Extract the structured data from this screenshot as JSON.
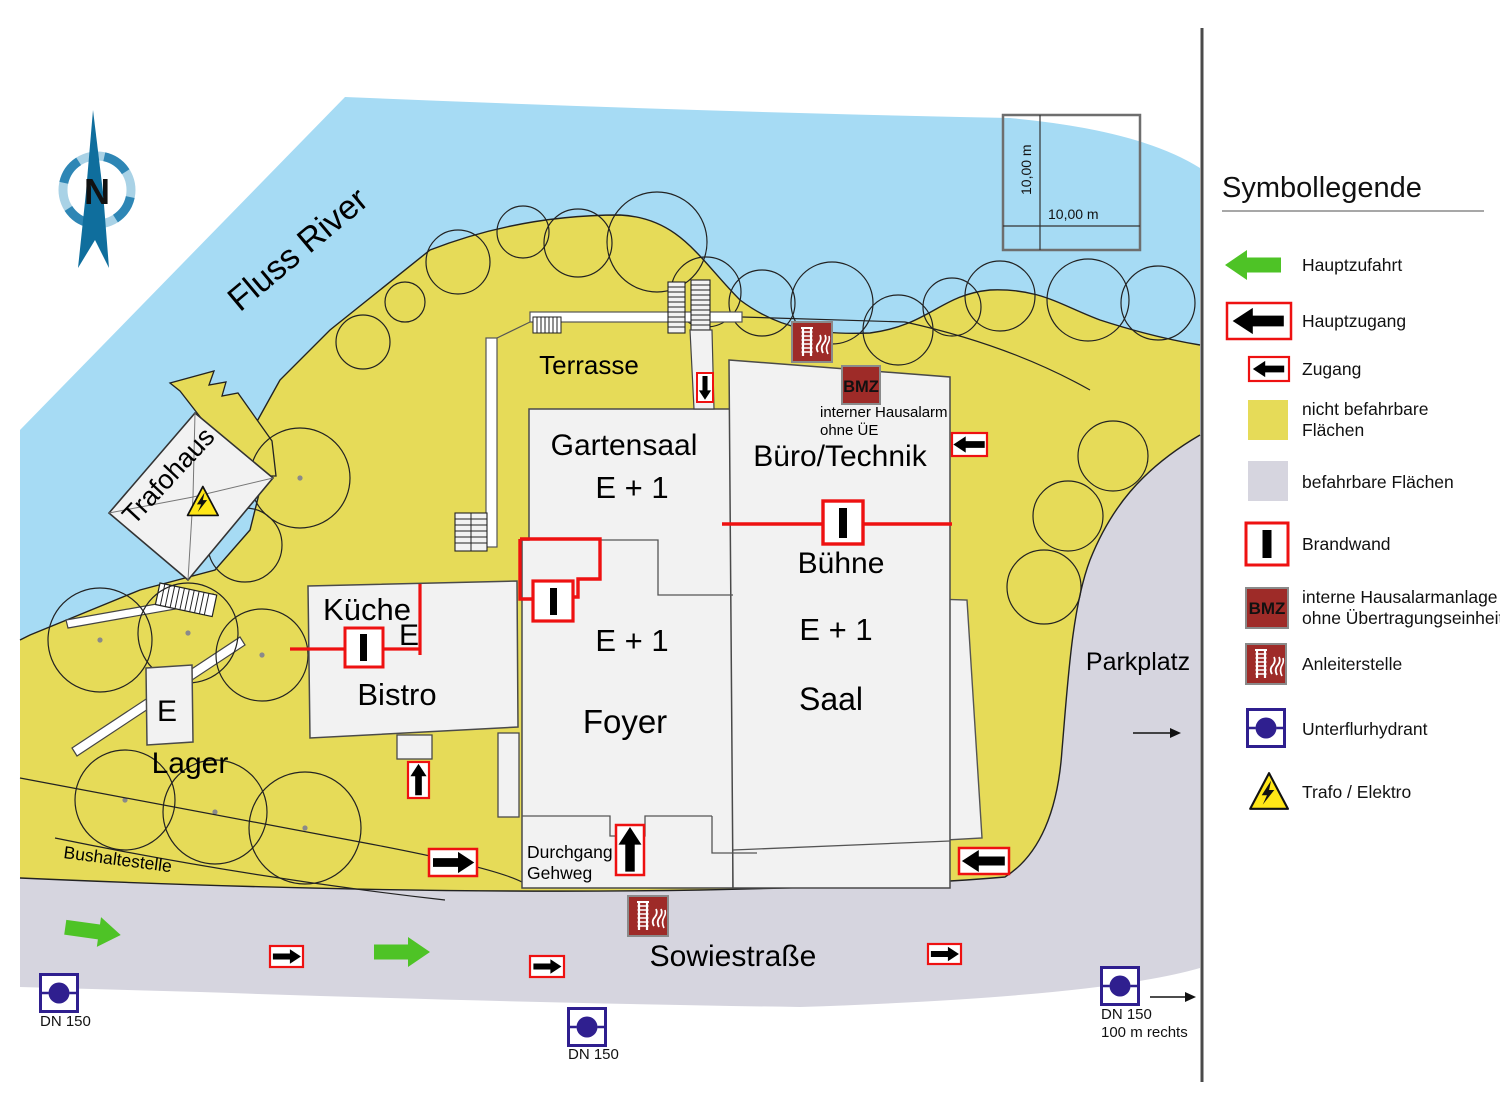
{
  "colors": {
    "water": "#A6DBF4",
    "restricted_area": "#E6DB58",
    "drivable_area": "#D6D5DF",
    "building": "#F2F2F2",
    "brandwand_red": "#EE1111",
    "alarm_red": "#9E2B28",
    "hydrant_blue": "#2F1F8F",
    "access_green": "#4EC326",
    "trafo_yellow": "#FFE617",
    "compass_blue": "#0F6E9D"
  },
  "map": {
    "river_label": "Fluss River",
    "compass_letter": "N",
    "scale_vertical_label": "10,00 m",
    "scale_horizontal_label": "10,00 m",
    "terrasse_label": "Terrasse",
    "trafohaus_label": "Trafohaus",
    "bushaltestelle_label": "Bushaltestelle",
    "sowiestrasse_label": "Sowiestraße",
    "parkplatz_label": "Parkplatz",
    "bmz_label": "BMZ",
    "hausalarm_note_line1": "interner Hausalarm",
    "hausalarm_note_line2": "ohne ÜE",
    "buildings": {
      "gartensaal_name": "Gartensaal",
      "gartensaal_level": "E + 1",
      "kueche_name": "Küche",
      "kueche_level": "E",
      "bistro_name": "Bistro",
      "lager_level": "E",
      "lager_name": "Lager",
      "foyer_level": "E + 1",
      "foyer_name": "Foyer",
      "durchgang_line1": "Durchgang",
      "durchgang_line2": "Gehweg",
      "buero_name": "Büro/Technik",
      "buehne_name": "Bühne",
      "saal_level": "E + 1",
      "saal_name": "Saal"
    },
    "hydrants": {
      "west_label": "DN 150",
      "center_label": "DN 150",
      "east_label_line1": "DN 150",
      "east_label_line2": "100 m rechts"
    }
  },
  "legend": {
    "title": "Symbollegende",
    "bmz_icon_text": "BMZ",
    "items": [
      {
        "label": "Hauptzufahrt"
      },
      {
        "label": "Hauptzugang"
      },
      {
        "label": "Zugang"
      },
      {
        "label": "nicht befahrbare",
        "label2": "Flächen"
      },
      {
        "label": "befahrbare Flächen"
      },
      {
        "label": "Brandwand"
      },
      {
        "label": "interne Hausalarmanlage",
        "label2": "ohne Übertragungseinheit"
      },
      {
        "label": "Anleiterstelle"
      },
      {
        "label": "Unterflurhydrant"
      },
      {
        "label": "Trafo / Elektro"
      }
    ]
  }
}
